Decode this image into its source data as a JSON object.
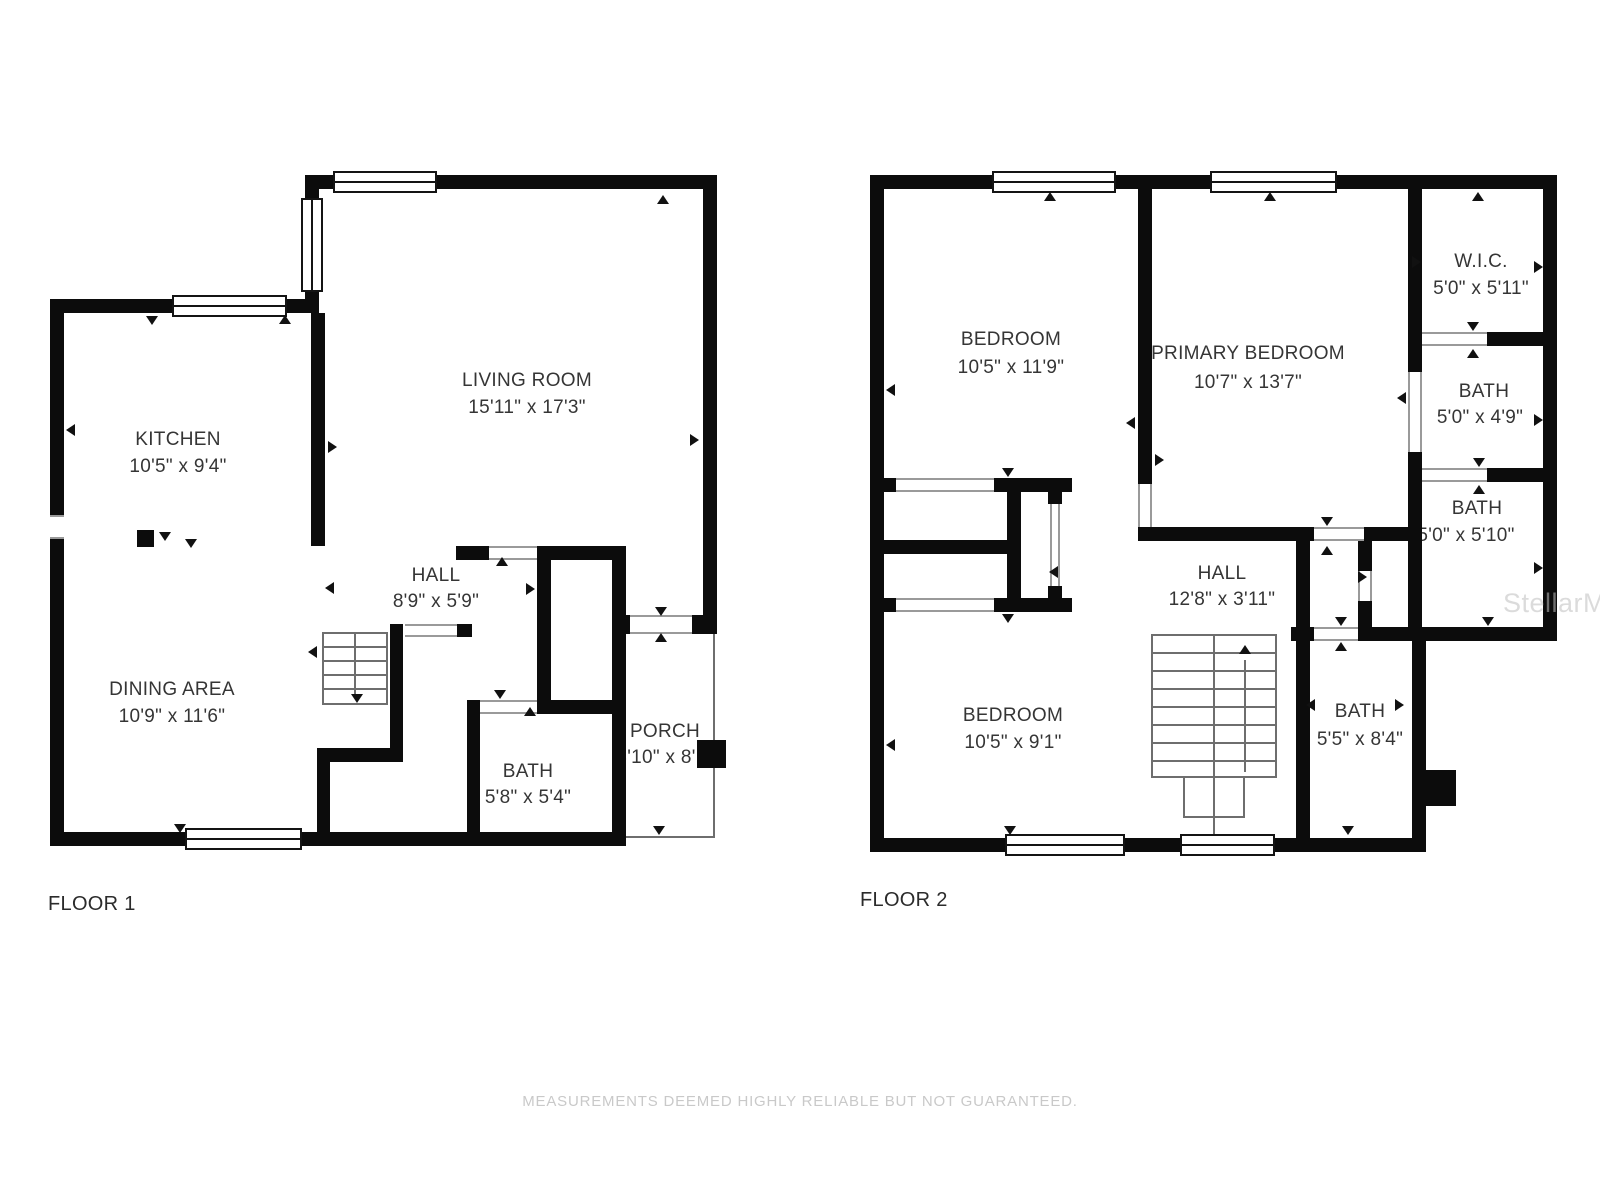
{
  "floors": [
    {
      "label": "FLOOR 1",
      "rooms": [
        {
          "id": "kitchen",
          "name": "KITCHEN",
          "dims": "10'5\" x 9'4\""
        },
        {
          "id": "living-room",
          "name": "LIVING ROOM",
          "dims": "15'11\" x 17'3\""
        },
        {
          "id": "hall",
          "name": "HALL",
          "dims": "8'9\" x 5'9\""
        },
        {
          "id": "dining-area",
          "name": "DINING AREA",
          "dims": "10'9\" x 11'6\""
        },
        {
          "id": "bath",
          "name": "BATH",
          "dims": "5'8\" x 5'4\""
        },
        {
          "id": "porch",
          "name": "PORCH",
          "dims": "3'10\" x 8'"
        }
      ]
    },
    {
      "label": "FLOOR 2",
      "rooms": [
        {
          "id": "bedroom-1",
          "name": "BEDROOM",
          "dims": "10'5\" x 11'9\""
        },
        {
          "id": "primary",
          "name": "PRIMARY BEDROOM",
          "dims": "10'7\" x 13'7\""
        },
        {
          "id": "wic",
          "name": "W.I.C.",
          "dims": "5'0\" x 5'11\""
        },
        {
          "id": "bath-1",
          "name": "BATH",
          "dims": "5'0\" x 4'9\""
        },
        {
          "id": "bath-2",
          "name": "BATH",
          "dims": "5'0\" x 5'10\""
        },
        {
          "id": "hall-2",
          "name": "HALL",
          "dims": "12'8\" x 3'11\""
        },
        {
          "id": "bedroom-2",
          "name": "BEDROOM",
          "dims": "10'5\" x 9'1\""
        },
        {
          "id": "bath-3",
          "name": "BATH",
          "dims": "5'5\" x 8'4\""
        }
      ]
    }
  ],
  "watermark": "StellarMLS",
  "disclaimer": "MEASUREMENTS DEEMED HIGHLY RELIABLE BUT NOT GUARANTEED."
}
